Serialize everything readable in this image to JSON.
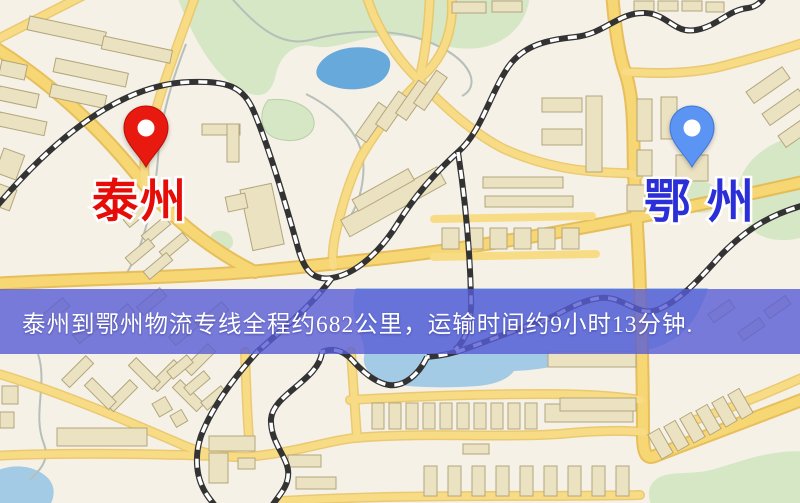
{
  "banner": {
    "text": "泰州到鄂州物流专线全程约682公里，运输时间约9小时13分钟.",
    "background_rgba": "rgba(88,92,214,0.8)",
    "text_color": "#ffffff"
  },
  "route": {
    "origin": "泰州",
    "destination": "鄂州",
    "distance": "682公里",
    "duration": "9小时13分钟"
  },
  "markers": {
    "origin": {
      "label": "泰州",
      "pin_color": "#e8190e",
      "label_color": "#e60d09"
    },
    "destination": {
      "label": "鄂州",
      "pin_color": "#5b94f3",
      "label_color": "#2b2fd8"
    }
  },
  "colors": {
    "map_base": "#f5f1e6",
    "road_fill": "#f7d674",
    "road_casing": "#e5b94e",
    "minor_road_fill": "#f8dc85",
    "minor_road_casing": "#e9c35f",
    "building": "#ebe2c1",
    "building_outline": "#b3a67d",
    "park": "#d5e7c5",
    "water": "#a4cbe6",
    "lake": "#68a9dc",
    "railway": "#333333",
    "stream": "#b6bfb9"
  }
}
